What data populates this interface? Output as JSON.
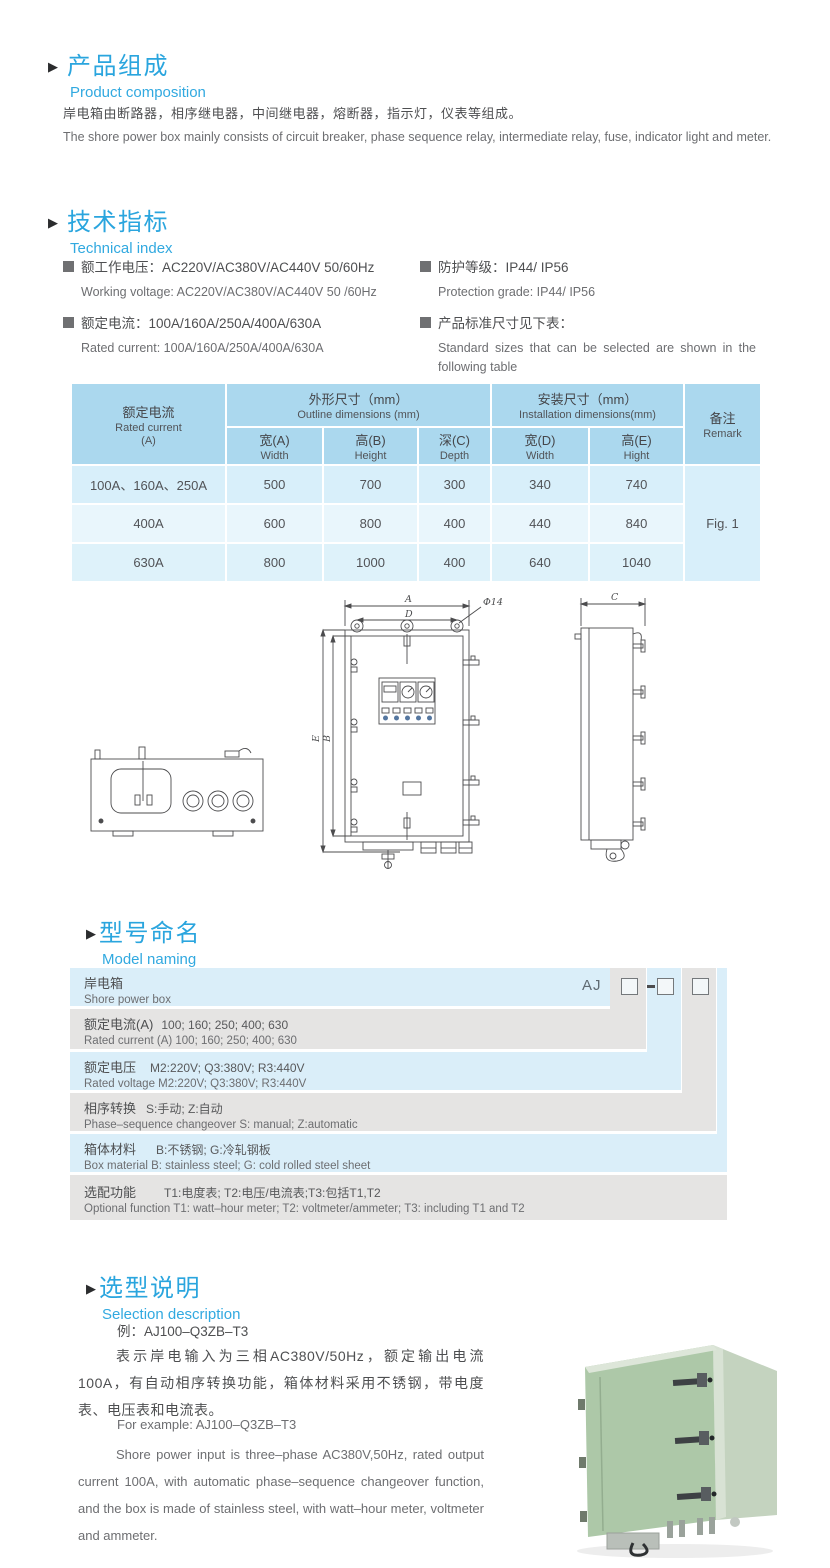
{
  "colors": {
    "accent_blue": "#2aa5de",
    "table_header_bg": "#abd8ee",
    "table_row_blue": "#d8effa",
    "naming_blue": "#daeef9",
    "naming_gray": "#e5e4e3",
    "text_dark": "#4e4f51",
    "text_gray": "#6d6e71",
    "box_green": "#adc8a8"
  },
  "composition": {
    "title_cn": "产品组成",
    "title_en": "Product  composition",
    "body_cn": "岸电箱由断路器，相序继电器，中间继电器，熔断器，指示灯，仪表等组成。",
    "body_en": "The shore power box mainly consists of circuit breaker, phase sequence relay, intermediate relay, fuse, indicator light and meter."
  },
  "technical": {
    "title_cn": "技术指标",
    "title_en": "Technical index",
    "specs": [
      {
        "cn": "额工作电压：AC220V/AC380V/AC440V  50/60Hz",
        "en": "Working voltage: AC220V/AC380V/AC440V 50 /60Hz"
      },
      {
        "cn": "额定电流：100A/160A/250A/400A/630A",
        "en": "Rated current: 100A/160A/250A/400A/630A"
      },
      {
        "cn": "防护等级：IP44/ IP56",
        "en": "Protection grade: IP44/ IP56"
      },
      {
        "cn": "产品标准尺寸见下表：",
        "en": "Standard sizes that can be selected are shown in the following table"
      }
    ]
  },
  "dim_table": {
    "header": {
      "current_cn": "额定电流",
      "current_en": "Rated current",
      "current_unit": "(A)",
      "outline_cn": "外形尺寸（mm）",
      "outline_en": "Outline dimensions (mm)",
      "install_cn": "安装尺寸（mm）",
      "install_en": "Installation dimensions(mm)",
      "remark_cn": "备注",
      "remark_en": "Remark",
      "sub": [
        {
          "cn": "宽(A)",
          "en": "Width"
        },
        {
          "cn": "高(B)",
          "en": "Height"
        },
        {
          "cn": "深(C)",
          "en": "Depth"
        },
        {
          "cn": "宽(D)",
          "en": "Width"
        },
        {
          "cn": "高(E)",
          "en": "Hight"
        }
      ]
    },
    "rows": [
      {
        "current": "100A、160A、250A",
        "values": [
          "500",
          "700",
          "300",
          "340",
          "740"
        ]
      },
      {
        "current": "400A",
        "values": [
          "600",
          "800",
          "400",
          "440",
          "840"
        ]
      },
      {
        "current": "630A",
        "values": [
          "800",
          "1000",
          "400",
          "640",
          "1040"
        ]
      }
    ],
    "remark": "Fig. 1"
  },
  "drawing": {
    "labels": {
      "A": "A",
      "D": "D",
      "phi": "Φ14",
      "E": "E",
      "B": "B",
      "C": "C"
    }
  },
  "naming": {
    "title_cn": "型号命名",
    "title_en": "Model naming",
    "prefix": "AJ",
    "rows": [
      {
        "cn": "岸电箱",
        "cn_val": "",
        "en": "Shore power box"
      },
      {
        "cn": "额定电流(A)",
        "cn_val": "100; 160; 250; 400; 630",
        "en": "Rated current (A) 100; 160; 250; 400; 630"
      },
      {
        "cn": "额定电压",
        "cn_val": "M2:220V;  Q3:380V;  R3:440V",
        "en": "Rated voltage  M2:220V;  Q3:380V;  R3:440V"
      },
      {
        "cn": "相序转换",
        "cn_val": "S:手动; Z:自动",
        "en": "Phase–sequence changeover  S: manual;  Z:automatic"
      },
      {
        "cn": "箱体材料",
        "cn_val": "B:不锈钢;  G:冷轧钢板",
        "en": "Box material   B: stainless steel; G: cold rolled steel sheet"
      },
      {
        "cn": "选配功能",
        "cn_val": "T1:电度表;  T2:电压/电流表;T3:包括T1,T2",
        "en": "Optional function  T1: watt–hour meter; T2: voltmeter/ammeter; T3: including T1 and T2"
      }
    ]
  },
  "selection": {
    "title_cn": "选型说明",
    "title_en": "Selection description",
    "example_cn": "例：AJ100–Q3ZB–T3",
    "body_cn": "表示岸电输入为三相AC380V/50Hz，额定输出电流100A，有自动相序转换功能，箱体材料采用不锈钢，带电度表、电压表和电流表。",
    "example_en": "For example: AJ100–Q3ZB–T3",
    "body_en": "Shore power input is three–phase AC380V,50Hz, rated output current 100A, with automatic phase–sequence changeover function, and the box is made of stainless steel, with watt–hour meter, voltmeter and ammeter."
  }
}
